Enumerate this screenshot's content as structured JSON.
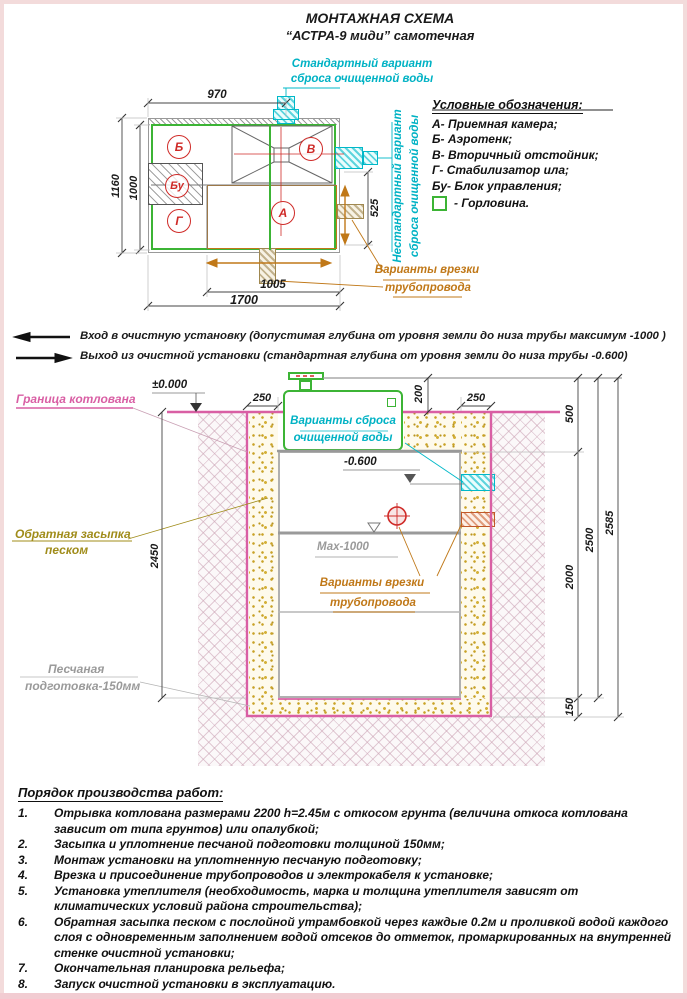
{
  "header": {
    "title": "МОНТАЖНАЯ СХЕМА",
    "subtitle": "“АСТРА-9 миди” самотечная"
  },
  "colors": {
    "cyan": "#00b2c4",
    "green": "#3cb435",
    "pink": "#d95fa4",
    "orange": "#c07818",
    "red": "#cf2a27",
    "olive": "#a08c1a",
    "sand": "#c9a227",
    "gray": "#9a9a9a"
  },
  "plan": {
    "chambers": {
      "reception": "А",
      "aerotank": "Б",
      "settler": "В",
      "stabilizer": "Г",
      "control": "Бу"
    },
    "dims": {
      "top": "970",
      "left_outer": "1160",
      "left_inner": "1000",
      "right": "525",
      "bottom_inner": "1005",
      "bottom_outer": "1700"
    },
    "standard_outlet": [
      "Стандартный вариант",
      "сброса очищенной воды"
    ],
    "nonstandard_outlet": [
      "Нестандартный вариант",
      "сброса очищенной воды"
    ],
    "pipe_note": [
      "Варианты врезки",
      "трубопровода"
    ]
  },
  "legend": {
    "title": "Условные обозначения:",
    "items": [
      "А- Приемная камера;",
      "Б- Аэротенк;",
      "В- Вторичный отстойник;",
      "Г- Стабилизатор ила;",
      "Бу- Блок управления;"
    ],
    "gorlovina": "- Горловина."
  },
  "flow_notes": {
    "inlet": "Вход в очистную установку (допустимая глубина от уровня земли до низа трубы максимум -1000 )",
    "outlet": "Выход из очистной установки (стандартная глубина от уровня земли до низа трубы -0.600)"
  },
  "section": {
    "levels": {
      "ground": "±0.000",
      "outlet": "-0.600",
      "inlet_max": "Мах-1000"
    },
    "dims": {
      "left_offset": "250",
      "cover_height": "200",
      "right_offset": "250",
      "top": "500",
      "tank": "2000",
      "bed": "150",
      "inner_total": "2500",
      "total": "2585",
      "depth": "2450"
    },
    "labels": {
      "pit_boundary": "Граница котлована",
      "backfill": [
        "Обратная засыпка",
        "песком"
      ],
      "sand_base": [
        "Песчаная",
        "подготовка-150мм"
      ],
      "discharge": [
        "Варианты сброса",
        "очищенной воды"
      ],
      "pipe_note": [
        "Варианты врезки",
        "трубопровода"
      ]
    }
  },
  "procedure": {
    "title": "Порядок производства работ:",
    "items": [
      {
        "num": "1.",
        "text": "Отрывка котлована размерами 2200 h=2.45м с откосом грунта (величина откоса котлована зависит от типа грунтов) или опалубкой;"
      },
      {
        "num": "2.",
        "text": "Засыпка и уплотнение песчаной подготовки толщиной 150мм;"
      },
      {
        "num": "3.",
        "text": "Монтаж установки на уплотненную песчаную подготовку;"
      },
      {
        "num": "4.",
        "text": "Врезка и присоединение трубопроводов и электрокабеля к установке;"
      },
      {
        "num": "5.",
        "text": "Установка утеплителя (необходимость, марка и толщина утеплителя зависят от климатических условий района строительства);"
      },
      {
        "num": "6.",
        "text": "Обратная засыпка песком с послойной утрамбовкой через каждые 0.2м и проливкой водой каждого слоя с одновременным заполнением водой отсеков до отметок, промаркированных на внутренней стенке очистной установки;"
      },
      {
        "num": "7.",
        "text": "Окончательная планировка рельефа;"
      },
      {
        "num": "8.",
        "text": "Запуск очистной установки в эксплуатацию."
      }
    ]
  }
}
